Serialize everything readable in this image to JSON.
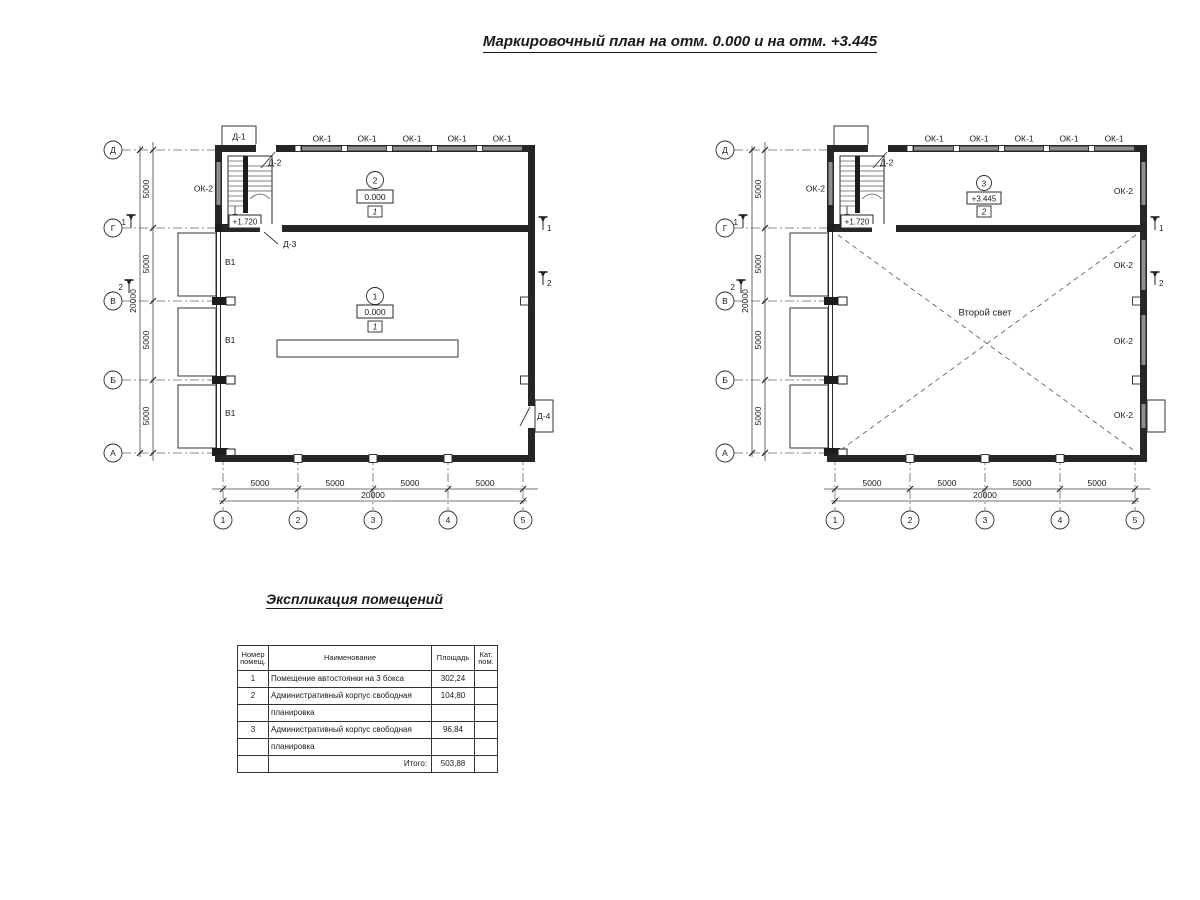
{
  "title": "Маркировочный план на отм. 0.000 и на отм. +3.445",
  "axes": {
    "rows": [
      "Д",
      "Г",
      "В",
      "Б",
      "А"
    ],
    "cols": [
      "1",
      "2",
      "3",
      "4",
      "5"
    ],
    "bay": "5000",
    "total": "20000"
  },
  "sections": {
    "s1": "1",
    "s2": "2"
  },
  "labels": {
    "ok1": "ОК-1",
    "ok2": "ОК-2",
    "v1": "В1",
    "d1": "Д-1",
    "d2": "Д-2",
    "d3": "Д-3",
    "d4": "Д-4",
    "stair_level": "+1.720",
    "second_light": "Второй свет"
  },
  "rooms": {
    "r1": {
      "num": "1",
      "level": "0.000",
      "cat": "1"
    },
    "r2": {
      "num": "2",
      "level": "0.000",
      "cat": "1"
    },
    "r3": {
      "num": "3",
      "level": "+3.445",
      "cat": "2"
    }
  },
  "table": {
    "title": "Экспликация помещений",
    "headers": {
      "num": "Номер помещ.",
      "name": "Наименование",
      "area": "Площадь",
      "cat": "Кат. пом."
    },
    "rows": [
      {
        "num": "1",
        "name": "Помещение автостоянки на 3 бокса",
        "area": "302,24",
        "cat": ""
      },
      {
        "num": "2",
        "name": "Административный корпус свободная",
        "area": "104,80",
        "cat": ""
      },
      {
        "num": "",
        "name": "планировка",
        "area": "",
        "cat": ""
      },
      {
        "num": "3",
        "name": "Административный корпус свободная",
        "area": "96,84",
        "cat": ""
      },
      {
        "num": "",
        "name": "планировка",
        "area": "",
        "cat": ""
      },
      {
        "num": "",
        "name": "Итого:",
        "area": "503,88",
        "cat": ""
      }
    ]
  }
}
